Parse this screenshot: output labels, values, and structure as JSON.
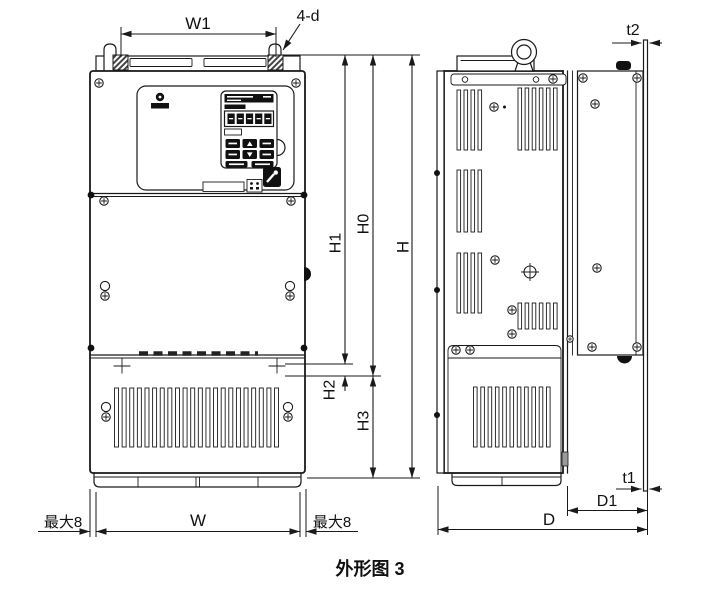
{
  "figure": {
    "caption": "外形图 3",
    "type": "technical-outline-drawing",
    "views": [
      "front-view",
      "side-view"
    ]
  },
  "dimension_labels": {
    "w1": "W1",
    "mounting_holes": "4-d",
    "t2": "t2",
    "h1": "H1",
    "h0": "H0",
    "h": "H",
    "h2": "H2",
    "h3": "H3",
    "max8_left": "最大8",
    "w": "W",
    "max8_right": "最大8",
    "t1": "t1",
    "d1": "D1",
    "d": "D"
  },
  "colors": {
    "line": "#1a1a1a",
    "fill": "#ffffff",
    "accent_dark": "#111111"
  }
}
